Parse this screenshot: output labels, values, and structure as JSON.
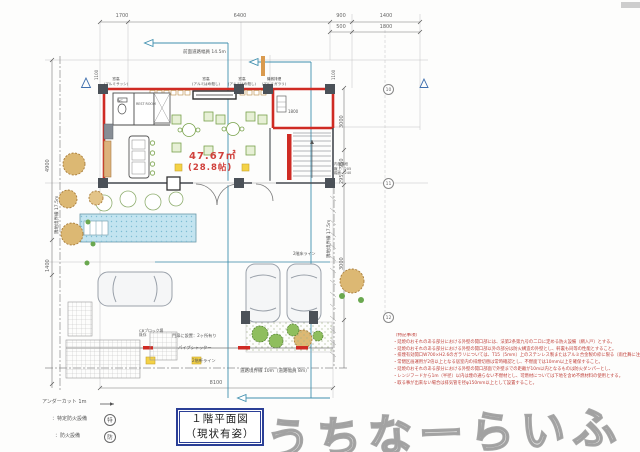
{
  "page": {
    "title_line1": "１階平面図",
    "title_line2": "（現状有姿）",
    "watermark": "うちなーらいふ"
  },
  "dimensions": {
    "top": [
      "1700",
      "6400",
      "900",
      "1400"
    ],
    "top_sub": [
      "500",
      "1800"
    ],
    "top_side": [
      "1100",
      "1100"
    ],
    "left": [
      "4900",
      "1400"
    ],
    "right": [
      "3000",
      "950",
      "295",
      "3000"
    ],
    "bottom": "8100",
    "room": "1800"
  },
  "grid_bubbles": [
    "10",
    "11",
    "12"
  ],
  "site": {
    "front_road": "前面道路幅員 14.5m",
    "boundary_left": "隣地境界線 17.5m",
    "boundary_right": "隣地境界線 17.5m",
    "road_bottom": "道路境界線 10m（道路幅員 8m）"
  },
  "plan": {
    "area_m2": "47.67㎡",
    "area_jo": "(28.8帖)",
    "wc": "WC",
    "rest_room": "REST ROOM",
    "floor2_line": "2階床ライン",
    "windows": [
      {
        "l1": "窓高",
        "l2": "(アルミサッシ)"
      },
      {
        "l1": "窓高",
        "l2": "(アルミはめ殺し)"
      },
      {
        "l1": "窓高",
        "l2": "(アルミはめ殺し)"
      },
      {
        "l1": "機械排煙",
        "l2": "(アルミガラリ)"
      }
    ],
    "stair_note": [
      "内部階段",
      "蹴上：205",
      "踏面：240"
    ],
    "gate_note": "門扉に設置：2ヶ所有り",
    "pipe_shutter": "パイプシャッター",
    "eave_line": "2階軒ライン",
    "cb_wall_1": "CBブロック塀",
    "cb_wall_2": "既存"
  },
  "legend": {
    "undercut": "アンダーカット 1m",
    "item1_label": "：特定防火設備",
    "item1_symbol": "特",
    "item2_label": "：防火設備",
    "item2_symbol": "防"
  },
  "notes": {
    "header": "（特記事項）",
    "lines": [
      "・延焼のおそれのある部分における外壁の開口部には、法第2条第九号の二ロに定める防火設備（網入戸）とする。",
      "・延焼のおそれのある部分における外壁の開口部以外の部分は防火構造の外壁とし、軒裏も同等の性能とすること。",
      "・排煙有効開口W700×H2.6のガラリについては、T15（5mm）上のステンレス製またはアルミ合金製の枠に限る（雨仕舞に注意）。",
      "・常閉区画運用が2倍以上となる居室内の排煙切替は常時確認とし、不燃面では10mm以上を確保すること。",
      "・延焼のおそれのある部分における外壁の開口部面で外壁までの距離が10m以内となるものは防火ダンパーとし、",
      "・レンジフードから1m（半径）以内は煙の通らない不燃材とし、可燃材については下地を含め不燃材料の使用とする。",
      "・取る事が出来ない場合は排気管を径φ150mm以上として設置すること。"
    ]
  },
  "colors": {
    "wall_red": "#cf2b24",
    "accent_teal": "#3f8fae",
    "note_red": "#c0403a",
    "pool_blue": "#c3e4f0",
    "title_border": "#2b3f96"
  }
}
